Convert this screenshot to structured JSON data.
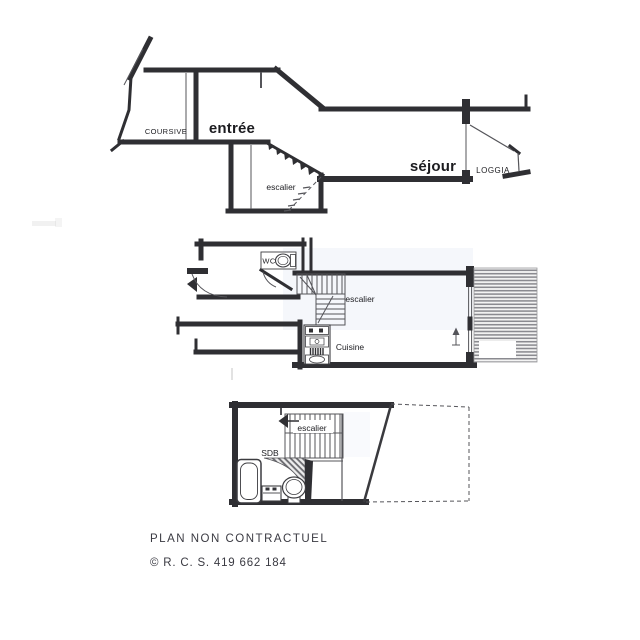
{
  "colors": {
    "ink": "#2f2f33",
    "line_soft": "#55555a",
    "hatch": "#8a8a90",
    "tint": "#dbe4f2",
    "paper": "#ffffff",
    "text": "#1c1c20",
    "footer_text": "#3a3a42"
  },
  "plans": {
    "upper": {
      "labels": {
        "coursive": "COURSIVE",
        "entree": "entrée",
        "escalier": "escalier",
        "sejour": "séjour",
        "loggia": "LOGGIA"
      }
    },
    "middle": {
      "labels": {
        "wc": "WC",
        "escalier": "escalier",
        "cuisine": "Cuisine"
      }
    },
    "lower": {
      "labels": {
        "escalier": "escalier",
        "sdb": "SDB"
      }
    }
  },
  "footer": {
    "disclaimer": "PLAN NON CONTRACTUEL",
    "registration": "© R. C. S. 419 662 184"
  }
}
